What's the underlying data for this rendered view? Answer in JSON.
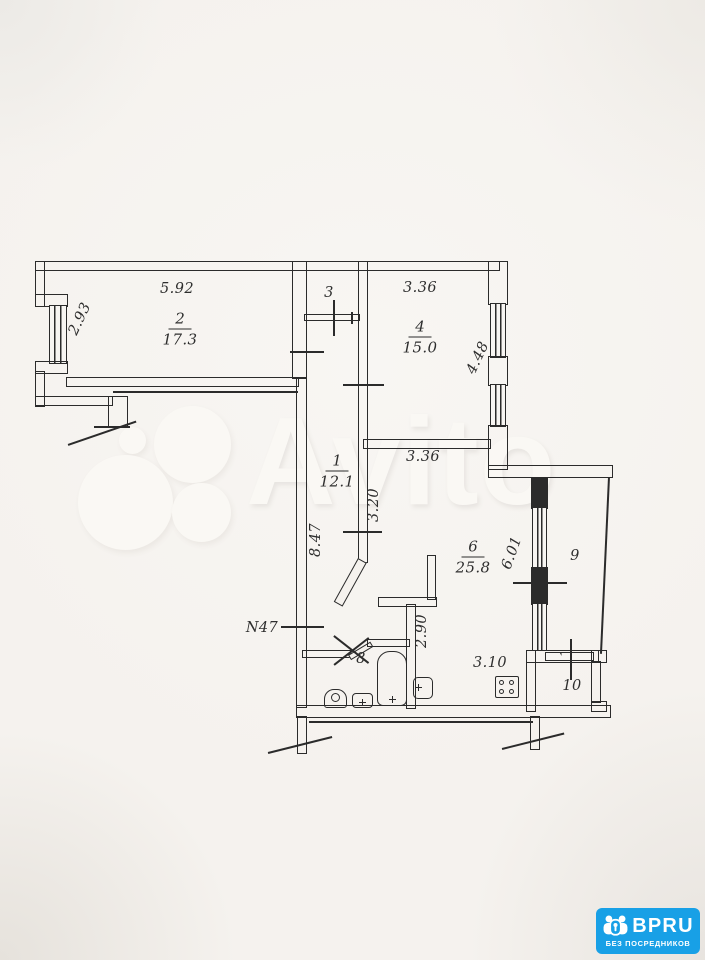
{
  "colors": {
    "ink": "#2b2b2b",
    "paper": "#f5f2ee",
    "logo_blue": "#18a0e6"
  },
  "watermark": {
    "text": "Avito"
  },
  "logo": {
    "brand": "BPRU",
    "tagline": "БЕЗ ПОСРЕДНИКОВ"
  },
  "plan": {
    "apartment_label": "N47",
    "rooms": {
      "r1": {
        "number": "1",
        "area": "12.1"
      },
      "r2": {
        "number": "2",
        "area": "17.3"
      },
      "r3": {
        "number": "3"
      },
      "r4": {
        "number": "4",
        "area": "15.0"
      },
      "r6": {
        "number": "6",
        "area": "25.8"
      },
      "r8": {
        "number": "8"
      },
      "r9": {
        "number": "9"
      },
      "r10": {
        "number": "10"
      }
    },
    "dimensions": {
      "room2_width": "5.92",
      "room2_depth": "2.93",
      "room4_width": "3.36",
      "room4_depth": "4.48",
      "room6_width": "3.36",
      "corridor_width": "3.20",
      "corridor_length": "8.47",
      "room6_depth": "6.01",
      "bath_wall": "2.90",
      "kitchen_width": "3.10"
    }
  }
}
